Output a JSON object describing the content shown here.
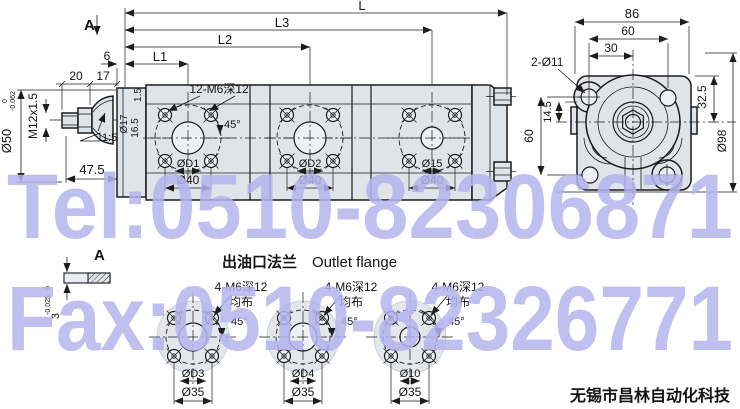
{
  "watermarks": {
    "tel": "Tel:0510-82306871",
    "fax": "Fax:0510-82326771",
    "color": "#b4b4ee"
  },
  "company": {
    "name": "无锡市昌林自动化科技"
  },
  "side_view": {
    "section_label": "A",
    "dims": {
      "L": "L",
      "L3": "L3",
      "L2": "L2",
      "L1": "L1",
      "gap6": "6",
      "len20": "20",
      "len17": "17",
      "shaft_dia": "Ø50",
      "shaft_tol_hi": "0",
      "shaft_tol_lo": "-0.062",
      "thread": "M12x1.5",
      "taper": "1:5",
      "len475": "47.5",
      "plate15": "1.5",
      "bore17": "Ø17",
      "depth165": "16.5"
    },
    "ports": {
      "bolt_note": "12-M6深12",
      "angle": "45°",
      "hole1": "ØD1",
      "hole2": "ØD2",
      "hole3": "Ø15",
      "pitch": "Ø40"
    }
  },
  "end_view": {
    "dims": {
      "w86": "86",
      "w60": "60",
      "w30": "30",
      "mount_holes": "2-Ø11",
      "h325": "32.5",
      "v60": "60",
      "v145": "14.5",
      "d98": "Ø98"
    }
  },
  "outlet": {
    "title_cn": "出油口法兰",
    "title_en": "Outlet flange",
    "key": {
      "label": "A",
      "height": "3",
      "tol_hi": "0",
      "tol_lo": "-0.025"
    },
    "flanges": [
      {
        "bolt_note": "4-M6深12",
        "spread": "均布",
        "angle": "45°",
        "hole": "ØD3",
        "pitch": "Ø35"
      },
      {
        "bolt_note": "4-M6深12",
        "spread": "均布",
        "angle": "45°",
        "hole": "ØD4",
        "pitch": "Ø35"
      },
      {
        "bolt_note": "4-M6深12",
        "spread": "均布",
        "angle": "45°",
        "hole": "Ø10",
        "pitch": "Ø35"
      }
    ]
  }
}
